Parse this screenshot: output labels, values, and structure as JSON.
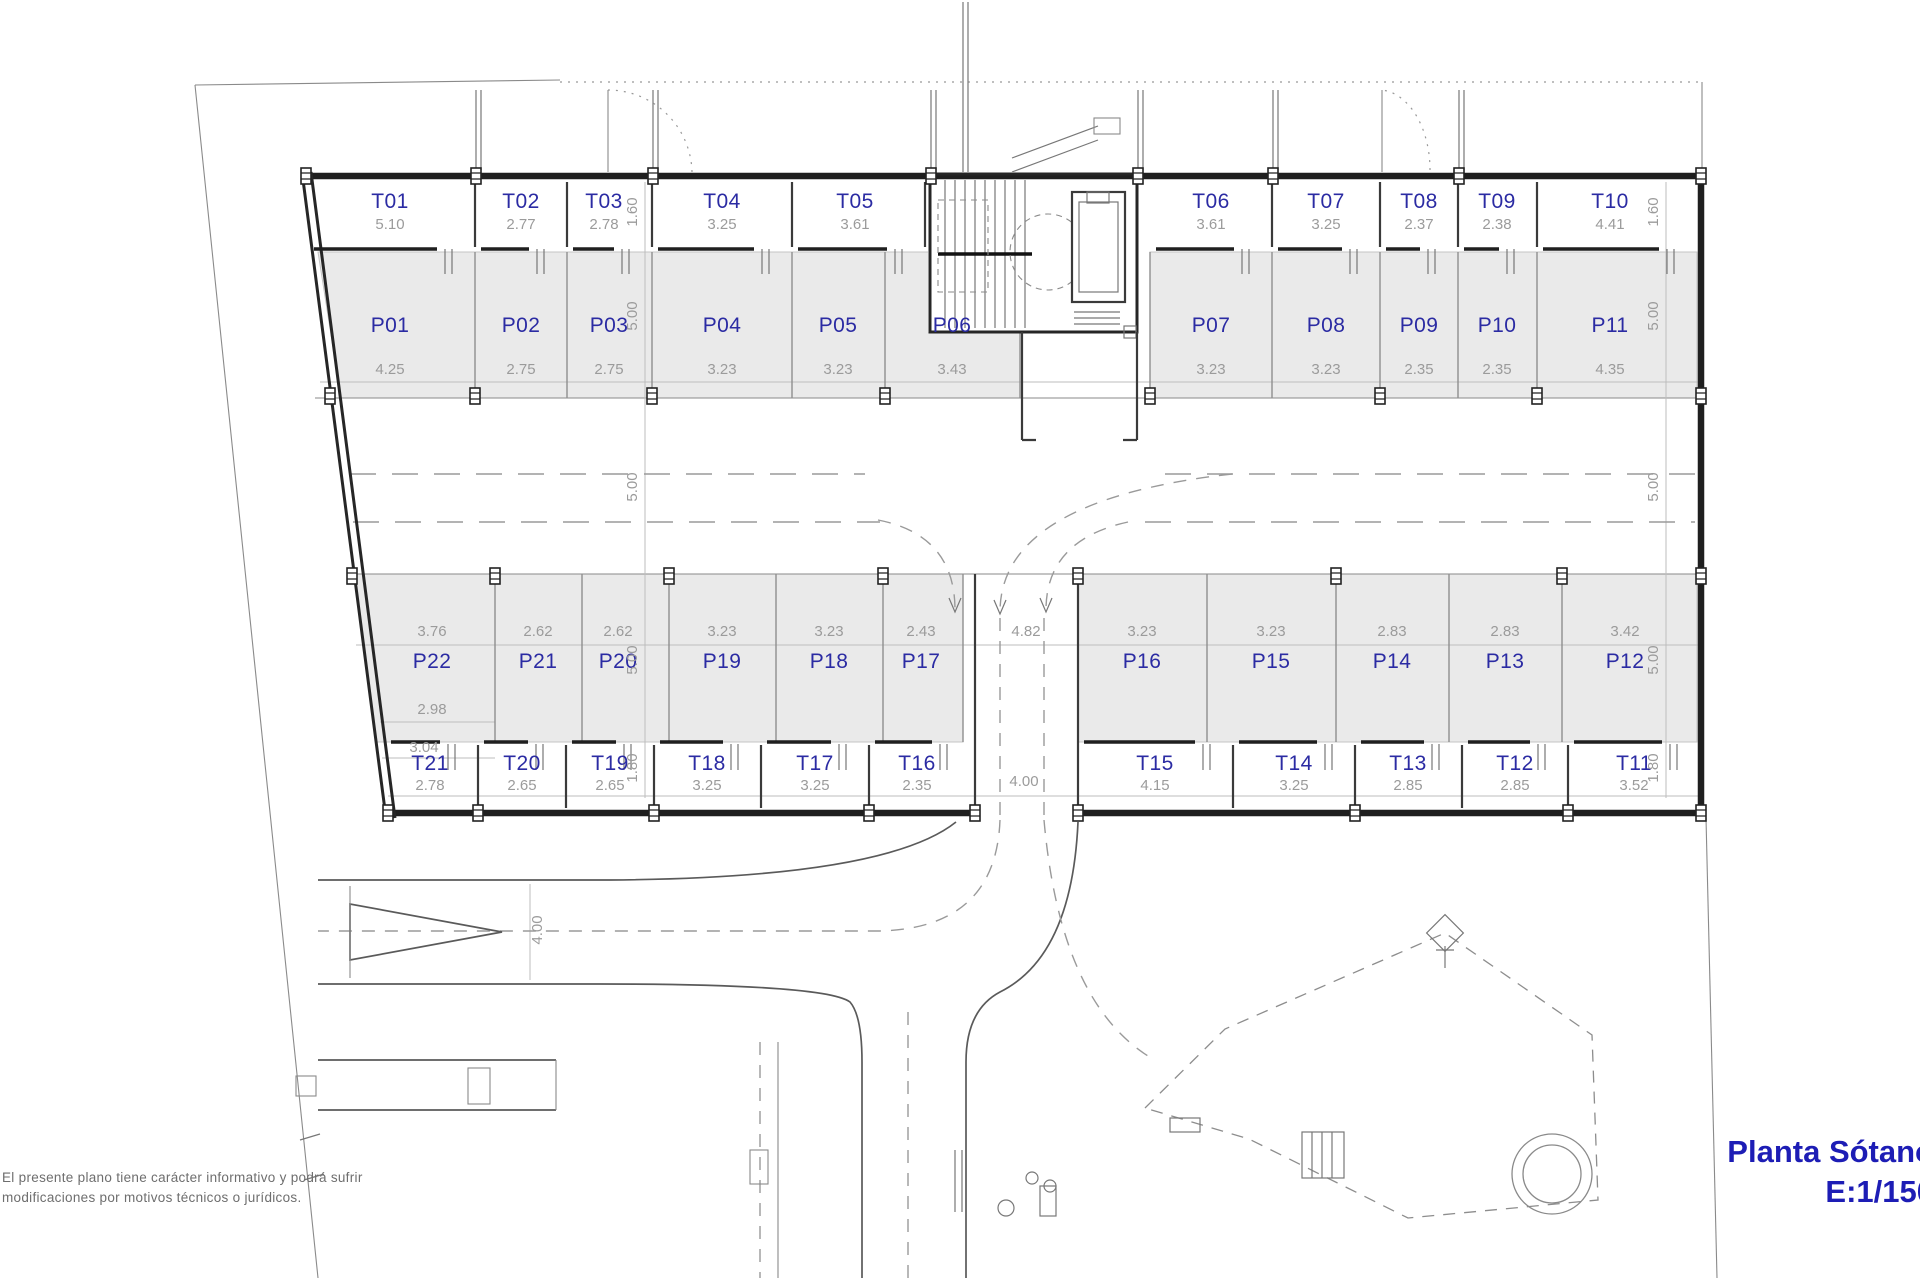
{
  "title": {
    "main": "Planta Sótano",
    "scale": "E:1/150"
  },
  "note": {
    "line1": "El presente plano tiene carácter informativo y podrá sufrir",
    "line2": "modificaciones por motivos técnicos o jurídicos."
  },
  "colors": {
    "label_blue": "#2b2ba3",
    "title_blue": "#1d1db5",
    "dim_gray": "#9b9b9b",
    "stall_fill": "#eaeaea",
    "line_dark": "#1f1f1f"
  },
  "upper_trasteros": [
    {
      "label": "T01",
      "dim": "5.10"
    },
    {
      "label": "T02",
      "dim": "2.77"
    },
    {
      "label": "T03",
      "dim": "2.78"
    },
    {
      "label": "T04",
      "dim": "3.25"
    },
    {
      "label": "T05",
      "dim": "3.61"
    },
    {
      "label": "T06",
      "dim": "3.61"
    },
    {
      "label": "T07",
      "dim": "3.25"
    },
    {
      "label": "T08",
      "dim": "2.37"
    },
    {
      "label": "T09",
      "dim": "2.38"
    },
    {
      "label": "T10",
      "dim": "4.41"
    }
  ],
  "upper_parking": [
    {
      "label": "P01",
      "dim": "4.25"
    },
    {
      "label": "P02",
      "dim": "2.75"
    },
    {
      "label": "P03",
      "dim": "2.75"
    },
    {
      "label": "P04",
      "dim": "3.23"
    },
    {
      "label": "P05",
      "dim": "3.23"
    },
    {
      "label": "P06",
      "dim": "3.43"
    },
    {
      "label": "P07",
      "dim": "3.23"
    },
    {
      "label": "P08",
      "dim": "3.23"
    },
    {
      "label": "P09",
      "dim": "2.35"
    },
    {
      "label": "P10",
      "dim": "2.35"
    },
    {
      "label": "P11",
      "dim": "4.35"
    }
  ],
  "lower_parking_left": [
    {
      "label": "P22",
      "dim": "3.76"
    },
    {
      "label": "P21",
      "dim": "2.62"
    },
    {
      "label": "P20",
      "dim": "2.62"
    },
    {
      "label": "P19",
      "dim": "3.23"
    },
    {
      "label": "P18",
      "dim": "3.23"
    },
    {
      "label": "P17",
      "dim": "2.43"
    }
  ],
  "lower_parking_right": [
    {
      "label": "P16",
      "dim": "3.23"
    },
    {
      "label": "P15",
      "dim": "3.23"
    },
    {
      "label": "P14",
      "dim": "2.83"
    },
    {
      "label": "P13",
      "dim": "2.83"
    },
    {
      "label": "P12",
      "dim": "3.42"
    }
  ],
  "lower_trasteros_left": [
    {
      "label": "T21",
      "dim": "2.78"
    },
    {
      "label": "T20",
      "dim": "2.65"
    },
    {
      "label": "T19",
      "dim": "2.65"
    },
    {
      "label": "T18",
      "dim": "3.25"
    },
    {
      "label": "T17",
      "dim": "3.25"
    },
    {
      "label": "T16",
      "dim": "2.35"
    }
  ],
  "lower_trasteros_right": [
    {
      "label": "T15",
      "dim": "4.15"
    },
    {
      "label": "T14",
      "dim": "3.25"
    },
    {
      "label": "T13",
      "dim": "2.85"
    },
    {
      "label": "T12",
      "dim": "2.85"
    },
    {
      "label": "T11",
      "dim": "3.52"
    }
  ],
  "extra_dims": {
    "p22_width_a": "2.98",
    "p22_width_b": "3.04",
    "ramp_gap": "4.82",
    "road_width": "4.00",
    "ramp_width": "4.00"
  },
  "vertical_dims": {
    "upper_storage_left": "1.60",
    "upper_storage_right": "1.60",
    "upper_parking_left": "5.00",
    "upper_parking_right": "5.00",
    "aisle_left": "5.00",
    "aisle_right": "5.00",
    "lower_parking_left": "5.00",
    "lower_parking_right": "5.00",
    "lower_storage_left": "1.80",
    "lower_storage_right": "1.80"
  }
}
